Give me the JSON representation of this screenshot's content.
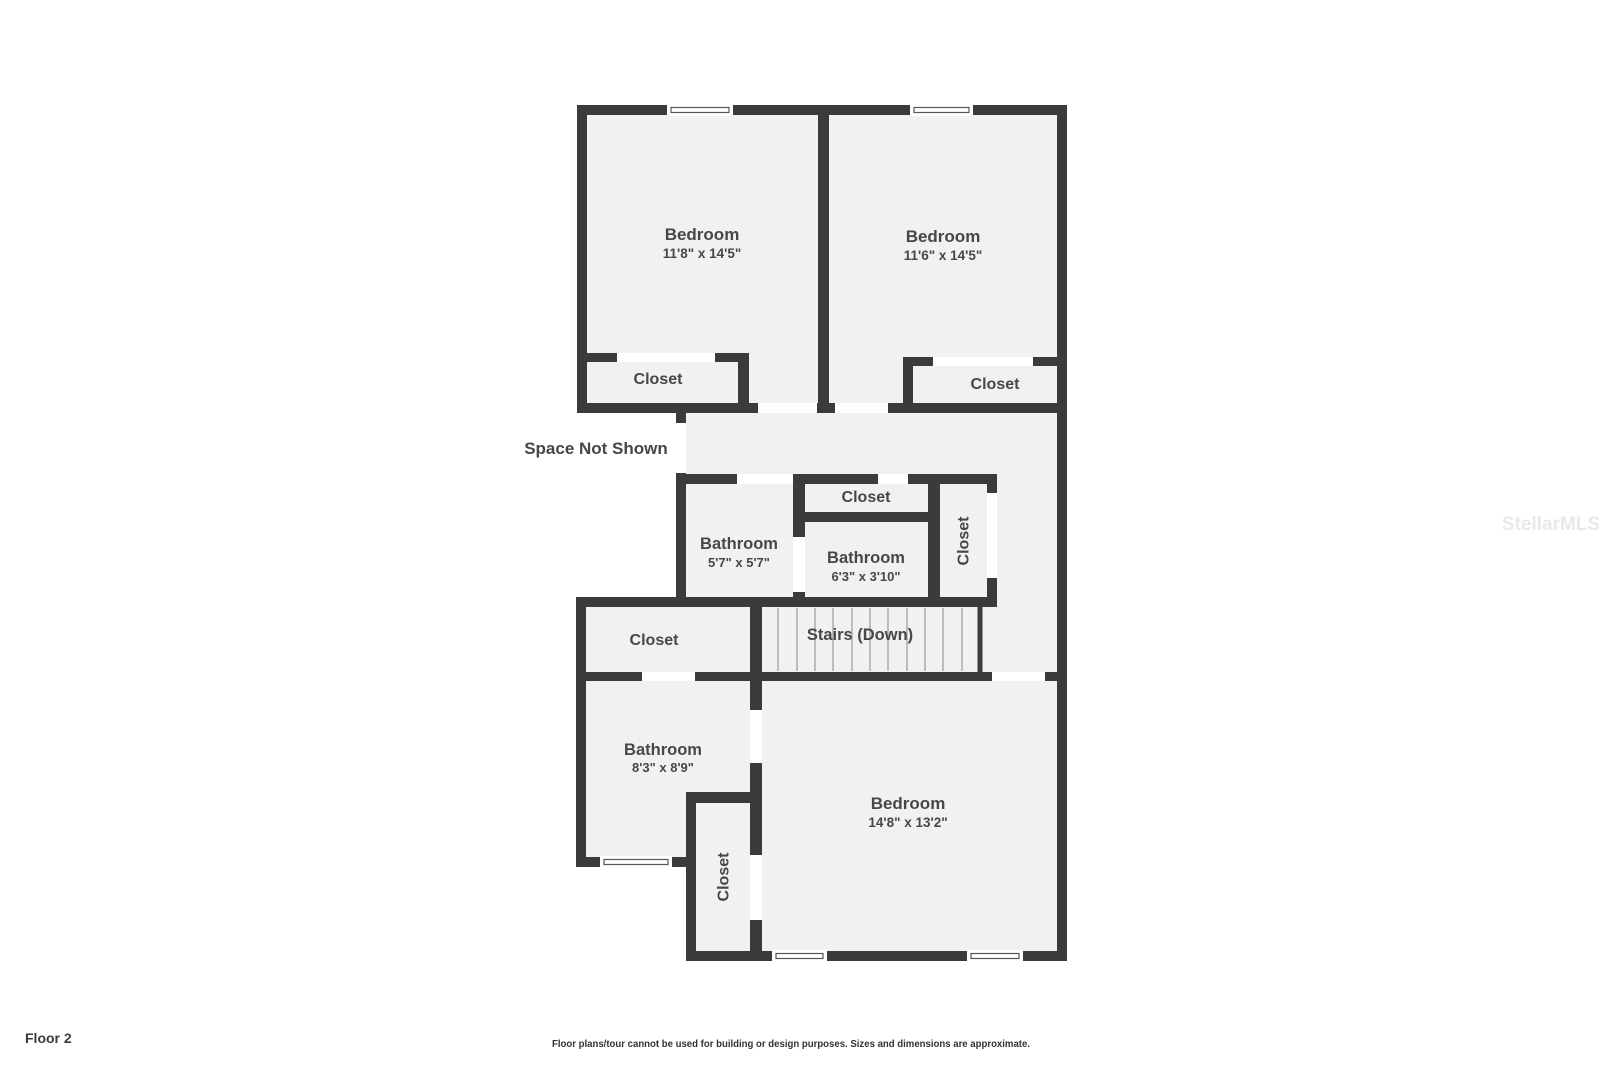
{
  "floor_label": "Floor 2",
  "disclaimer": "Floor plans/tour cannot be used for building or design purposes. Sizes and dimensions are approximate.",
  "watermark": "StellarMLS",
  "annotations": {
    "space_not_shown": "Space Not Shown",
    "stairs": "Stairs (Down)"
  },
  "rooms": {
    "bedroom_top_left": {
      "name": "Bedroom",
      "dims": "11'8\" x 14'5\""
    },
    "bedroom_top_right": {
      "name": "Bedroom",
      "dims": "11'6\" x 14'5\""
    },
    "closet_top_left": {
      "label": "Closet"
    },
    "closet_top_right": {
      "label": "Closet"
    },
    "bathroom_mid": {
      "name": "Bathroom",
      "dims": "5'7\" x 5'7\""
    },
    "closet_mid_small": {
      "label": "Closet"
    },
    "bathroom_mid_small": {
      "name": "Bathroom",
      "dims": "6'3\" x 3'10\""
    },
    "closet_mid_tall": {
      "label": "Closet"
    },
    "closet_by_stairs": {
      "label": "Closet"
    },
    "bathroom_bottom": {
      "name": "Bathroom",
      "dims": "8'3\" x 8'9\""
    },
    "closet_bottom": {
      "label": "Closet"
    },
    "bedroom_bottom": {
      "name": "Bedroom",
      "dims": "14'8\" x 13'2\""
    }
  },
  "colors": {
    "background": "#ffffff",
    "wall": "#3b3b3b",
    "floor": "#f1f1f1",
    "label_text": "#474747",
    "stair_tread": "#bdbdbd"
  }
}
